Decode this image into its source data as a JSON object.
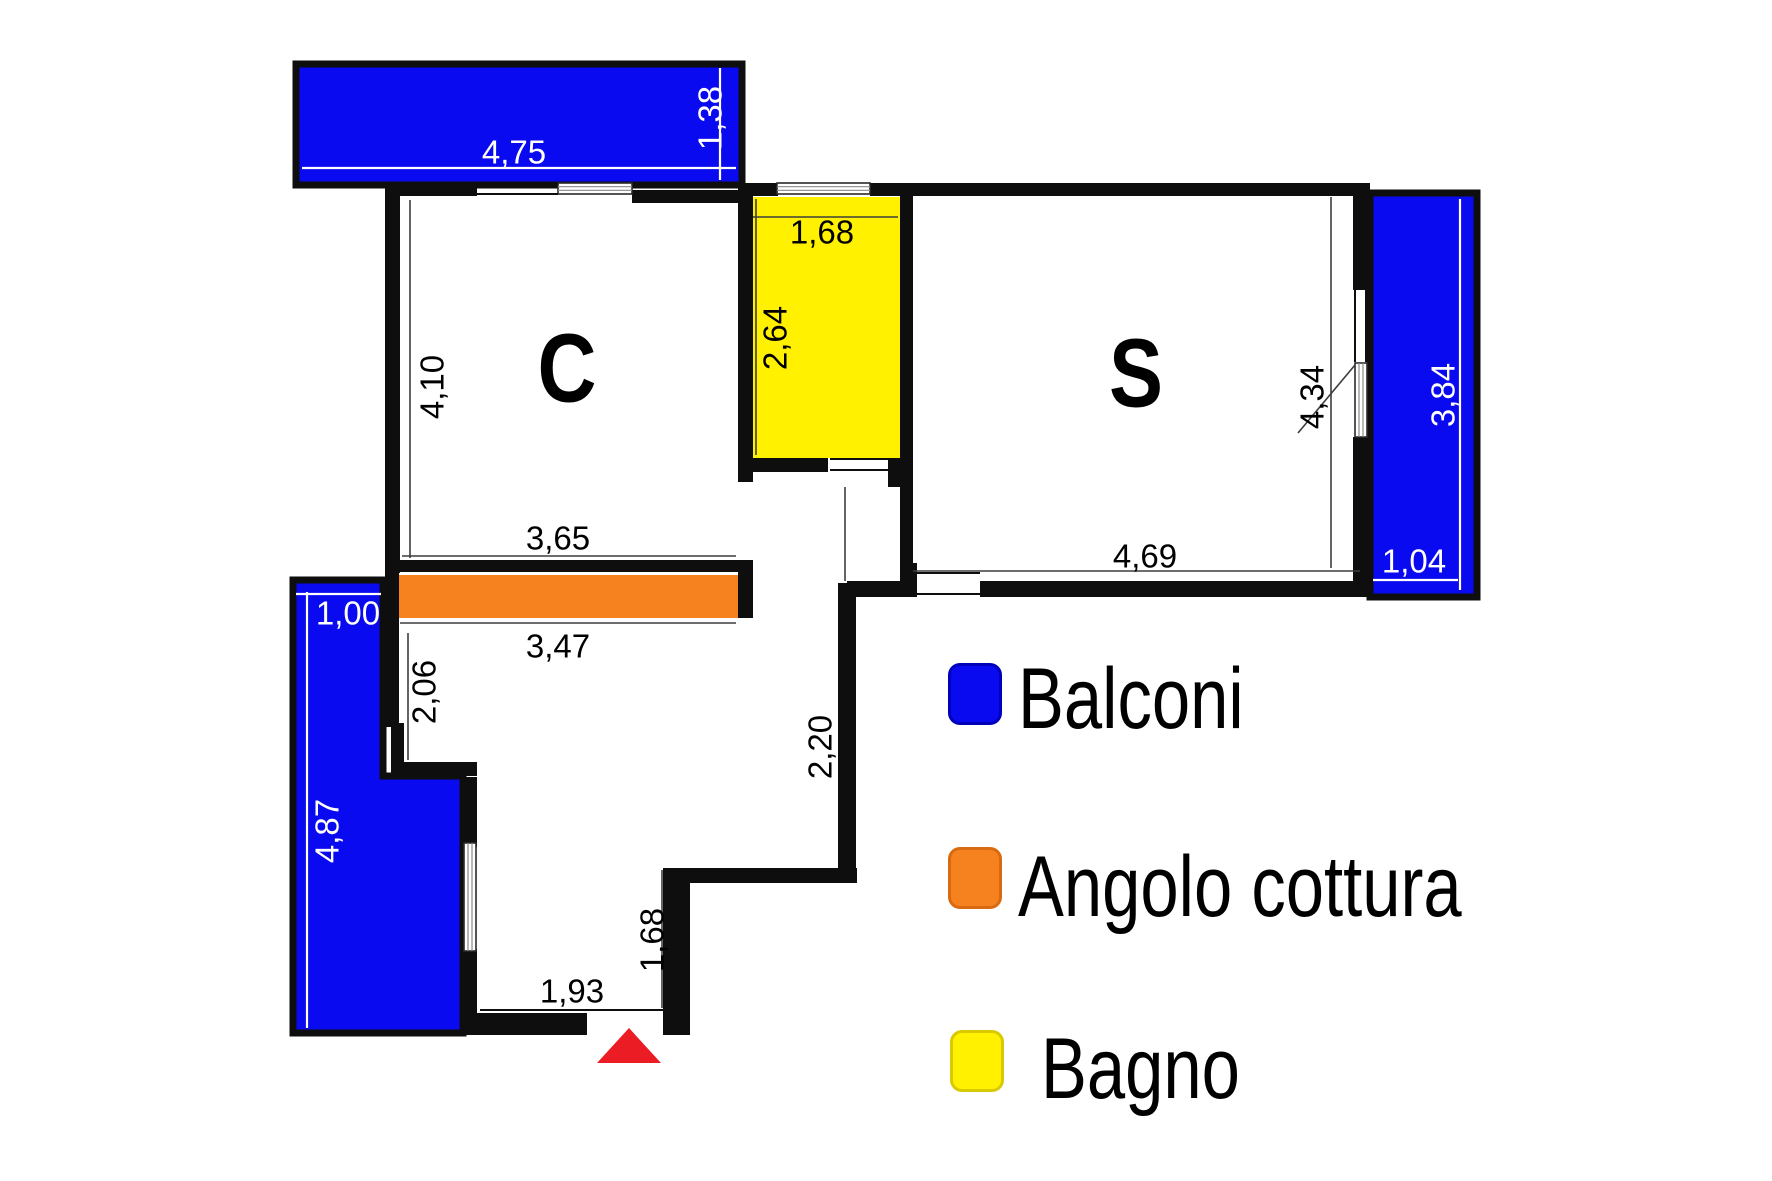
{
  "title": "Apartment floor plan",
  "colors": {
    "balcony": "#0a0af0",
    "balcony_border": "#0000bb",
    "kitchen": "#f5821f",
    "kitchen_border": "#d96a10",
    "bath": "#fff100",
    "bath_border": "#d9c900",
    "wall": "#0e0e0e",
    "dim_line": "#3d3d3d",
    "white_line": "#ffffff",
    "entrance": "#ec1c24",
    "text": "#000000"
  },
  "legend": {
    "items": [
      {
        "name": "balconi",
        "label": "Balconi",
        "color": "#0a0af0",
        "border": "#0000bb"
      },
      {
        "name": "angolo-cottura",
        "label": "Angolo cottura",
        "color": "#f5821f",
        "border": "#d96a10"
      },
      {
        "name": "bagno",
        "label": "Bagno",
        "color": "#fff100",
        "border": "#d9c900"
      }
    ]
  },
  "rooms": [
    {
      "name": "room-c",
      "label": "C",
      "x": 567,
      "y": 368,
      "size": 97,
      "textLength": 59
    },
    {
      "name": "room-s",
      "label": "S",
      "x": 1136,
      "y": 373,
      "size": 97,
      "textLength": 54
    }
  ],
  "plan": {
    "regions": [
      {
        "name": "balcony-top",
        "type": "rect",
        "x": 296,
        "y": 64,
        "w": 446,
        "h": 121,
        "fill": "balcony",
        "stroke": true
      },
      {
        "name": "balcony-right",
        "type": "rect",
        "x": 1370,
        "y": 193,
        "w": 107,
        "h": 404,
        "fill": "balcony",
        "stroke": true
      },
      {
        "name": "balcony-left",
        "type": "polygon",
        "points": "293,580 383,580 383,776 463,776 463,1033 293,1033",
        "fill": "balcony",
        "stroke": true
      },
      {
        "name": "bagno-floor",
        "type": "rect",
        "x": 750,
        "y": 197,
        "w": 153,
        "h": 261,
        "fill": "bath",
        "stroke": false
      },
      {
        "name": "angolo-cottura-counter",
        "type": "rect",
        "x": 398,
        "y": 575,
        "w": 340,
        "h": 43,
        "fill": "kitchen",
        "stroke": false
      }
    ],
    "walls": [
      [
        385,
        183,
        92,
        13
      ],
      [
        632,
        190,
        118,
        13
      ],
      [
        750,
        183,
        28,
        13
      ],
      [
        870,
        183,
        43,
        13
      ],
      [
        882,
        183,
        488,
        13
      ],
      [
        385,
        183,
        15,
        390
      ],
      [
        398,
        560,
        342,
        12
      ],
      [
        738,
        560,
        15,
        58
      ],
      [
        385,
        572,
        14,
        155
      ],
      [
        391,
        723,
        13,
        43
      ],
      [
        391,
        762,
        86,
        14
      ],
      [
        463,
        777,
        14,
        70
      ],
      [
        463,
        949,
        14,
        66
      ],
      [
        463,
        1013,
        124,
        22
      ],
      [
        663,
        868,
        27,
        167
      ],
      [
        663,
        868,
        194,
        15
      ],
      [
        838,
        583,
        18,
        300
      ],
      [
        738,
        183,
        15,
        299
      ],
      [
        738,
        458,
        90,
        14
      ],
      [
        888,
        458,
        25,
        29
      ],
      [
        900,
        183,
        13,
        390
      ],
      [
        900,
        563,
        17,
        25
      ],
      [
        847,
        581,
        70,
        16
      ],
      [
        980,
        581,
        385,
        16
      ],
      [
        1353,
        183,
        14,
        107
      ],
      [
        1353,
        437,
        14,
        160
      ]
    ],
    "windows": [
      {
        "name": "window-c-top",
        "x": 558,
        "y": 183,
        "w": 74,
        "h": 11,
        "dir": "h"
      },
      {
        "name": "window-bagno-top",
        "x": 777,
        "y": 183,
        "w": 93,
        "h": 11,
        "dir": "h"
      },
      {
        "name": "window-hall-left",
        "x": 464,
        "y": 843,
        "w": 12,
        "h": 108,
        "dir": "v"
      },
      {
        "name": "window-s-right",
        "x": 1355,
        "y": 363,
        "w": 12,
        "h": 74,
        "dir": "v"
      }
    ],
    "thresholds": [
      [
        477,
        184,
        558,
        184
      ],
      [
        477,
        194,
        558,
        194
      ],
      [
        1355,
        290,
        1355,
        362
      ],
      [
        1366,
        290,
        1366,
        362
      ],
      [
        917,
        573,
        980,
        573
      ],
      [
        917,
        594,
        980,
        594
      ],
      [
        830,
        459,
        888,
        459
      ],
      [
        830,
        470,
        888,
        470
      ],
      [
        480,
        1010,
        663,
        1010
      ]
    ],
    "dimlines_black": [
      [
        410,
        200,
        410,
        558
      ],
      [
        402,
        556,
        736,
        556
      ],
      [
        400,
        623,
        736,
        623
      ],
      [
        408,
        633,
        408,
        760
      ],
      [
        753,
        217,
        898,
        217
      ],
      [
        756,
        199,
        756,
        455
      ],
      [
        1331,
        197,
        1331,
        568
      ],
      [
        845,
        487,
        845,
        581
      ],
      [
        662,
        870,
        662,
        1008
      ],
      [
        913,
        571,
        1360,
        571
      ],
      [
        1355,
        365,
        1298,
        433
      ]
    ],
    "dimlines_white": [
      [
        302,
        168,
        736,
        168
      ],
      [
        720,
        68,
        720,
        180
      ],
      [
        1460,
        199,
        1460,
        590
      ],
      [
        1373,
        580,
        1458,
        580
      ],
      [
        296,
        594,
        381,
        594
      ],
      [
        307,
        592,
        307,
        1028
      ]
    ],
    "dim_labels": [
      {
        "text": "4,75",
        "x": 514,
        "y": 152,
        "rot": 0,
        "color": "white"
      },
      {
        "text": "1,38",
        "x": 710,
        "y": 118,
        "rot": -90,
        "color": "white"
      },
      {
        "text": "4,10",
        "x": 432,
        "y": 387,
        "rot": -90,
        "color": "black"
      },
      {
        "text": "1,68",
        "x": 822,
        "y": 232,
        "rot": 0,
        "color": "black"
      },
      {
        "text": "2,64",
        "x": 775,
        "y": 338,
        "rot": -90,
        "color": "black"
      },
      {
        "text": "4,34",
        "x": 1312,
        "y": 397,
        "rot": -90,
        "color": "black"
      },
      {
        "text": "3,84",
        "x": 1443,
        "y": 395,
        "rot": -90,
        "color": "white"
      },
      {
        "text": "1,04",
        "x": 1414,
        "y": 561,
        "rot": 0,
        "color": "white"
      },
      {
        "text": "3,65",
        "x": 558,
        "y": 538,
        "rot": 0,
        "color": "black"
      },
      {
        "text": "4,69",
        "x": 1145,
        "y": 556,
        "rot": 0,
        "color": "black"
      },
      {
        "text": "3,47",
        "x": 558,
        "y": 646,
        "rot": 0,
        "color": "black"
      },
      {
        "text": "1,00",
        "x": 348,
        "y": 613,
        "rot": 0,
        "color": "white"
      },
      {
        "text": "2,06",
        "x": 424,
        "y": 692,
        "rot": -90,
        "color": "black"
      },
      {
        "text": "4,87",
        "x": 327,
        "y": 831,
        "rot": -90,
        "color": "white"
      },
      {
        "text": "2,20",
        "x": 820,
        "y": 747,
        "rot": -90,
        "color": "black"
      },
      {
        "text": "1,68",
        "x": 652,
        "y": 940,
        "rot": -90,
        "color": "black"
      },
      {
        "text": "1,93",
        "x": 572,
        "y": 991,
        "rot": 0,
        "color": "black"
      }
    ],
    "entrance_triangle": "597,1063 661,1063 629,1028"
  }
}
